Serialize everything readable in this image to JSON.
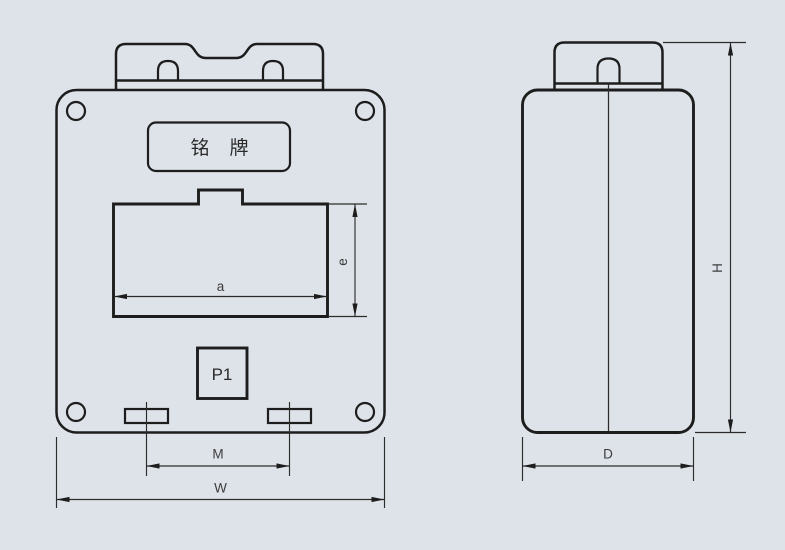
{
  "colors": {
    "background": "#dee3e9",
    "line": "#1d1d1d",
    "dim_text": "#3c3c3c"
  },
  "front_view": {
    "nameplate_label": "铭 牌",
    "p1_label": "P1",
    "dim_a_label": "a",
    "dim_e_label": "e",
    "dim_m_label": "M",
    "dim_w_label": "W"
  },
  "side_view": {
    "dim_d_label": "D",
    "dim_h_label": "H"
  }
}
